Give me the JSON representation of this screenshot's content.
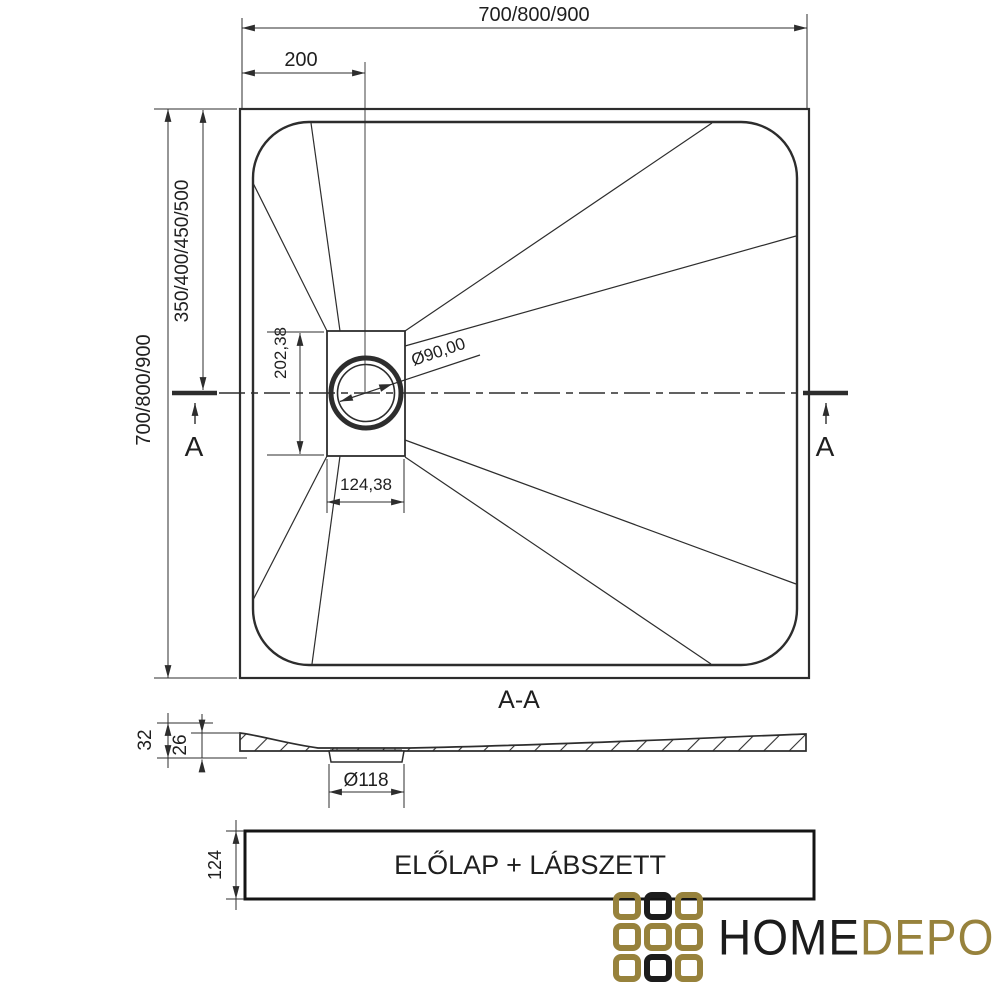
{
  "colors": {
    "line": "#2d2d2d",
    "gold": "#97823c",
    "dark": "#1c1c1c"
  },
  "plan": {
    "dim_width_top": "700/800/900",
    "dim_drain_offset": "200",
    "dim_height_left": "700/800/900",
    "dim_drain_center": "350/400/450/500",
    "dim_recess_height": "202,38",
    "dim_recess_width": "124,38",
    "dim_drain_diameter": "Ø90,00",
    "marker_left": "A",
    "marker_right": "A"
  },
  "section": {
    "title": "A-A",
    "dim_height_total": "32",
    "dim_height_body": "26",
    "dim_drain_hole": "Ø118"
  },
  "panel": {
    "label": "ELŐLAP + LÁBSZETT",
    "dim_height": "124"
  },
  "logo": {
    "word_primary": "HOME",
    "word_secondary": "DEPO",
    "grid": [
      [
        "gold",
        "dark",
        "gold"
      ],
      [
        "gold",
        "gold",
        "gold"
      ],
      [
        "gold",
        "dark",
        "gold"
      ]
    ]
  }
}
